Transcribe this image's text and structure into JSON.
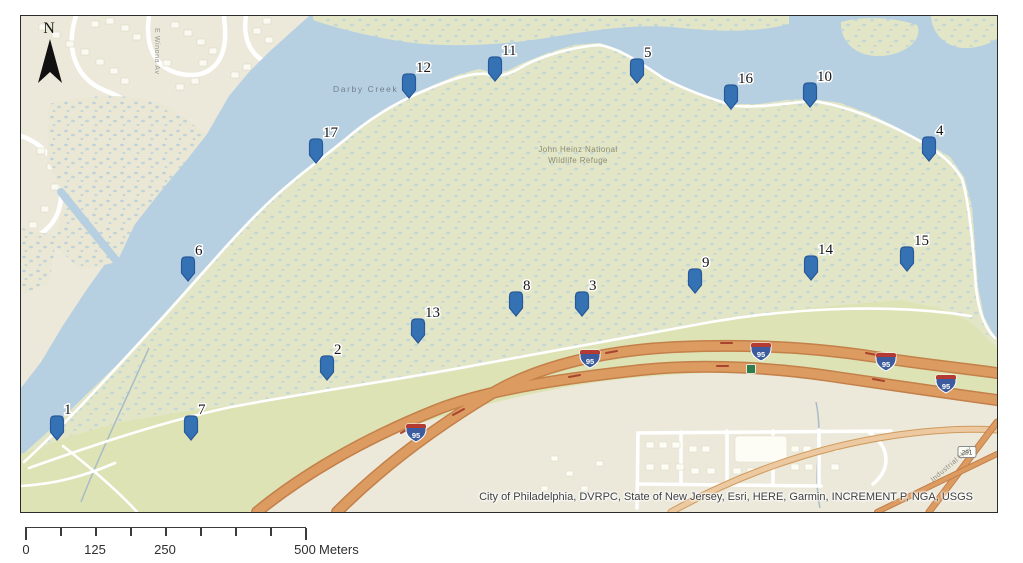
{
  "map": {
    "north_label": "N",
    "labels": {
      "creek": "Darby Creek",
      "refuge_line1": "John Heinz National",
      "refuge_line2": "Wildlife Refuge",
      "street_winona": "E Winona Av",
      "street_industrial": "Industrial Hwy",
      "route_badge": "291",
      "interstate_badge": "95"
    },
    "attribution": "City of Philadelphia, DVRPC, State of New Jersey, Esri, HERE, Garmin, INCREMENT P, NGA, USGS",
    "colors": {
      "water": "#b7d0e1",
      "urban": "#ece9da",
      "marsh": "#e2e6c6",
      "upland_green": "#dde3b4",
      "road_fill": "#db9b61",
      "road_casing": "#c4804a",
      "pin_fill": "#3572b4",
      "pin_stroke": "#27589a"
    },
    "markers": [
      {
        "id": "1",
        "x": 36,
        "y": 412
      },
      {
        "id": "2",
        "x": 306,
        "y": 352
      },
      {
        "id": "3",
        "x": 561,
        "y": 288
      },
      {
        "id": "4",
        "x": 908,
        "y": 133
      },
      {
        "id": "5",
        "x": 616,
        "y": 55
      },
      {
        "id": "6",
        "x": 167,
        "y": 253
      },
      {
        "id": "7",
        "x": 170,
        "y": 412
      },
      {
        "id": "8",
        "x": 495,
        "y": 288
      },
      {
        "id": "9",
        "x": 674,
        "y": 265
      },
      {
        "id": "10",
        "x": 789,
        "y": 79
      },
      {
        "id": "11",
        "x": 474,
        "y": 53
      },
      {
        "id": "12",
        "x": 388,
        "y": 70
      },
      {
        "id": "13",
        "x": 397,
        "y": 315
      },
      {
        "id": "14",
        "x": 790,
        "y": 252
      },
      {
        "id": "15",
        "x": 886,
        "y": 243
      },
      {
        "id": "16",
        "x": 710,
        "y": 81
      },
      {
        "id": "17",
        "x": 295,
        "y": 135
      }
    ],
    "interstate_shield_positions": [
      [
        395,
        417
      ],
      [
        569,
        343
      ],
      [
        740,
        336
      ],
      [
        865,
        346
      ],
      [
        925,
        368
      ]
    ]
  },
  "scale_bar": {
    "tick_labels": [
      "0",
      "125",
      "250",
      "500"
    ],
    "unit": "Meters"
  }
}
